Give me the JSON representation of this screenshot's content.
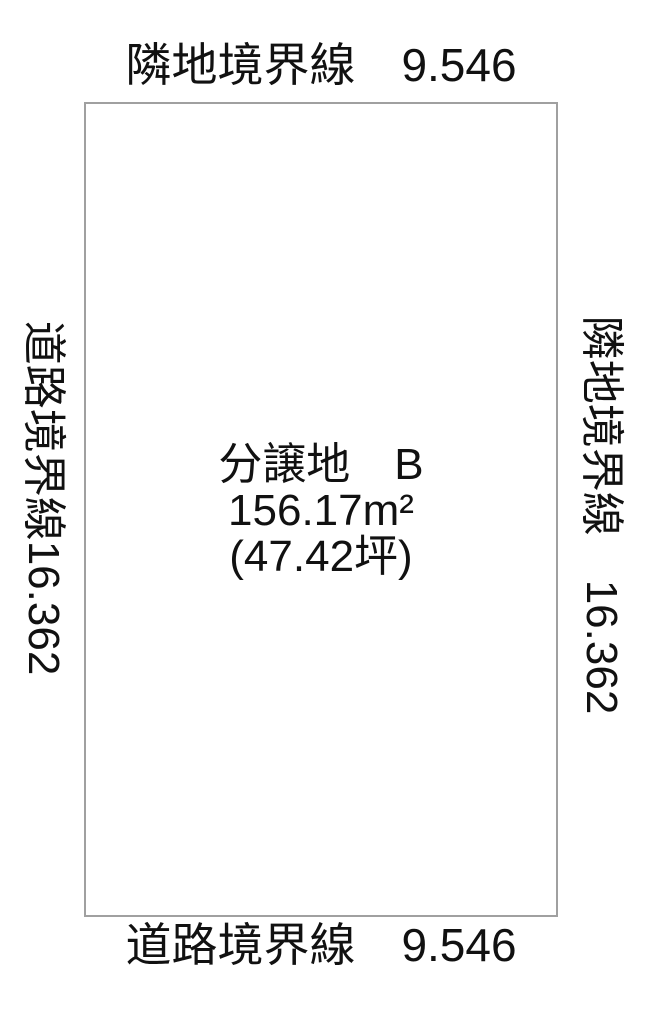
{
  "diagram": {
    "type": "land-plot-layout",
    "colors": {
      "background": "#ffffff",
      "plot_border": "#a0a0a0",
      "text": "#111111"
    },
    "plot": {
      "title": "分譲地　B",
      "area_m2_text": "156.17m²",
      "area_m2_value": 156.17,
      "area_tsubo_text": "(47.42坪)",
      "area_tsubo_value": 47.42
    },
    "boundaries": {
      "top": {
        "text": "隣地境界線　9.546",
        "label": "隣地境界線",
        "length": 9.546
      },
      "bottom": {
        "text": "道路境界線　9.546",
        "label": "道路境界線",
        "length": 9.546
      },
      "left": {
        "text": "道路境界線16.362",
        "label": "道路境界線",
        "length": 16.362
      },
      "right": {
        "text": "隣地境界線　16.362",
        "label": "隣地境界線",
        "length": 16.362
      }
    }
  }
}
